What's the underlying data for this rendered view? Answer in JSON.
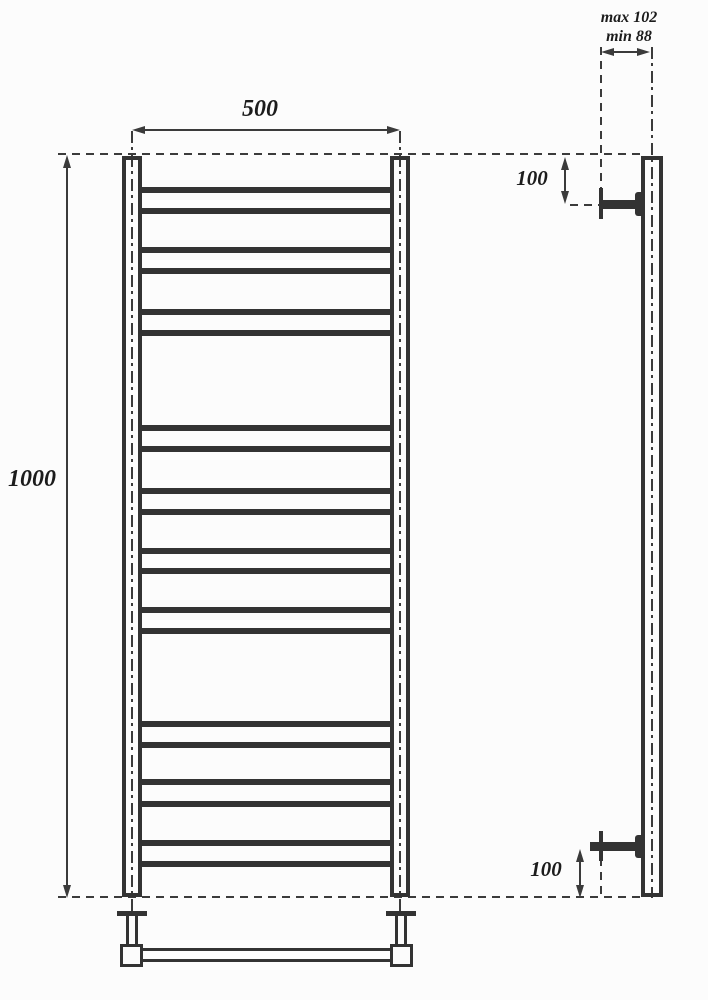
{
  "page": {
    "background": "#fcfcfc"
  },
  "drawing": {
    "type": "technical_drawing",
    "subject": "ladder towel rail - front view and side installation view",
    "line_color": "#333333",
    "dim_color": "#3b3b3b",
    "text_color": "#1c1c1c",
    "dimensions": {
      "width": "500",
      "height": "1000",
      "top_bracket_offset": "100",
      "bottom_bracket_offset": "100",
      "depth_max": "max 102",
      "depth_min": "min 88"
    },
    "front_view": {
      "rung_centers_y": [
        190,
        211,
        250,
        271,
        312,
        333,
        428,
        449,
        491,
        512,
        551,
        571,
        610,
        631,
        724,
        745,
        782,
        804,
        843,
        864
      ]
    }
  }
}
